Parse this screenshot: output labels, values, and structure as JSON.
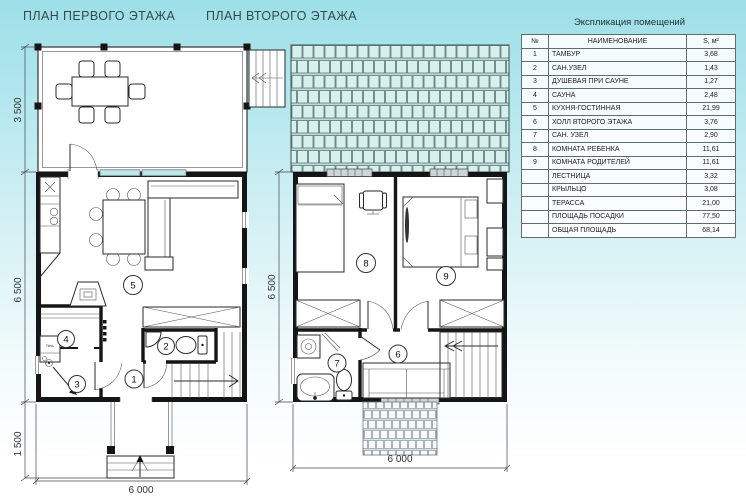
{
  "colors": {
    "background_top": "#9ddfe8",
    "background_bottom": "#ffffff",
    "wall": "#151515",
    "roof_shingle": "#d8f0ed",
    "window_glass": "#bfe7e4"
  },
  "plan1": {
    "title": "ПЛАН ПЕРВОГО ЭТАЖА",
    "dim_left_terrace": "3 500",
    "dim_left_main": "6 500",
    "dim_left_porch": "1 500",
    "dim_bottom": "6 000",
    "stove_label": "Печь",
    "room_labels": {
      "r1": "1",
      "r2": "2",
      "r3": "3",
      "r4": "4",
      "r5": "5"
    }
  },
  "plan2": {
    "title": "ПЛАН ВТОРОГО ЭТАЖА",
    "dim_left_main": "6 500",
    "dim_bottom": "6 000",
    "room_labels": {
      "r6": "6",
      "r7": "7",
      "r8": "8",
      "r9": "9"
    }
  },
  "legend": {
    "title": "Экспликация помещений",
    "headers": {
      "num": "№",
      "name": "НАИМЕНОВАНИЕ",
      "area": "S, м²"
    },
    "rows": [
      {
        "n": "1",
        "name": "ТАМБУР",
        "area": "3,68"
      },
      {
        "n": "2",
        "name": "САН.УЗЕЛ",
        "area": "1,43"
      },
      {
        "n": "3",
        "name": "ДУШЕВАЯ ПРИ САУНЕ",
        "area": "1,27"
      },
      {
        "n": "4",
        "name": "САУНА",
        "area": "2,48"
      },
      {
        "n": "5",
        "name": "КУХНЯ-ГОСТИННАЯ",
        "area": "21,99"
      },
      {
        "n": "6",
        "name": "ХОЛЛ  ВТОРОГО ЭТАЖА",
        "area": "3,76"
      },
      {
        "n": "7",
        "name": "САН. УЗЕЛ",
        "area": "2,90"
      },
      {
        "n": "8",
        "name": "КОМНАТА РЕБЕНКА",
        "area": "11,61"
      },
      {
        "n": "9",
        "name": "КОМНАТА РОДИТЕЛЕЙ",
        "area": "11,61"
      },
      {
        "n": "",
        "name": "ЛЕСТНИЦА",
        "area": "3,32"
      },
      {
        "n": "",
        "name": "КРЫЛЬЦО",
        "area": "3,08"
      },
      {
        "n": "",
        "name": "ТЕРАССА",
        "area": "21,00"
      },
      {
        "n": "",
        "name": "ПЛОЩАДЬ ПОСАДКИ",
        "area": "77,50"
      },
      {
        "n": "",
        "name": "ОБЩАЯ ПЛОЩАДЬ",
        "area": "68,14"
      }
    ]
  }
}
